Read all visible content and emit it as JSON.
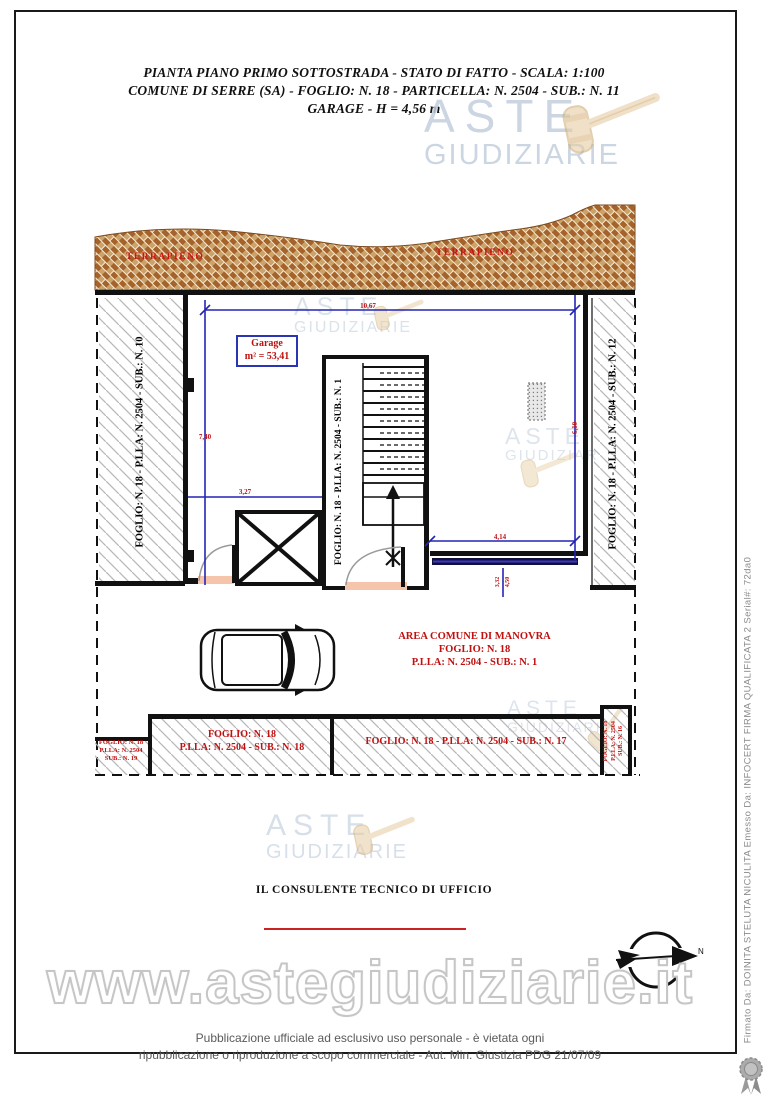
{
  "title": {
    "line1": "PIANTA PIANO PRIMO SOTTOSTRADA - STATO DI FATTO - SCALA: 1:100",
    "line2": "COMUNE DI SERRE (SA) - FOGLIO: N. 18 - PARTICELLA: N. 2504 - SUB.: N. 11",
    "line3": "GARAGE - H = 4,56 m"
  },
  "brand": {
    "word1": "ASTE",
    "word2": "GIUDIZIARIE",
    "url": "www.astegiudiziarie.it"
  },
  "plan": {
    "terrapieno": "TERRAPIENO",
    "garage": {
      "name": "Garage",
      "area": "m² = 53,41"
    },
    "parcel_left": "FOGLIO: N. 18 - P.LLA: N. 2504 - SUB.: N. 10",
    "parcel_stair": "FOGLIO: N. 18 - P.LLA: N. 2504 - SUB.: N. 1",
    "parcel_right": "FOGLIO: N. 18 - P.LLA: N. 2504 - SUB.: N. 12",
    "dims": {
      "top": "10,67",
      "left": "7,40",
      "inner": "3,27",
      "right": "6,10",
      "bottom": "4,14",
      "door_a": "3,32",
      "door_b": "4,50"
    },
    "manovra": {
      "line1": "AREA COMUNE DI MANOVRA",
      "line2": "FOGLIO: N. 18",
      "line3": "P.LLA: N. 2504 - SUB.: N. 1"
    },
    "parcel19": {
      "l1": "FOGLIO: N. 18",
      "l2": "P.LLA: N. 2504",
      "l3": "SUB.: N. 19"
    },
    "parcel18": {
      "l1": "FOGLIO: N. 18",
      "l2": "P.LLA: N. 2504 - SUB.: N. 18"
    },
    "parcel17": "FOGLIO: N. 18 - P.LLA: N. 2504 - SUB.: N. 17",
    "parcel16": {
      "l1": "FOGLIO: N. 18",
      "l2": "P.LLA: N. 2504",
      "l3": "SUB.: N. 16"
    },
    "compass": "N"
  },
  "consultant": "IL CONSULENTE TECNICO DI UFFICIO",
  "footer": {
    "line1": "Pubblicazione ufficiale ad esclusivo uso personale - è vietata ogni",
    "line2": "ripubblicazione o riproduzione a scopo commerciale - Aut. Min. Giustizia PDG 21/07/09"
  },
  "signature": "Firmato Da: DOINITA STELUTA NICULITA Emesso Da: INFOCERT FIRMA QUALIFICATA 2 Serial#: 72da0",
  "colors": {
    "label_red": "#c01010",
    "dim_blue": "#2525b5",
    "terrapieno_brown": "#a5622a",
    "watermark_blue": "#c3cfdd"
  }
}
